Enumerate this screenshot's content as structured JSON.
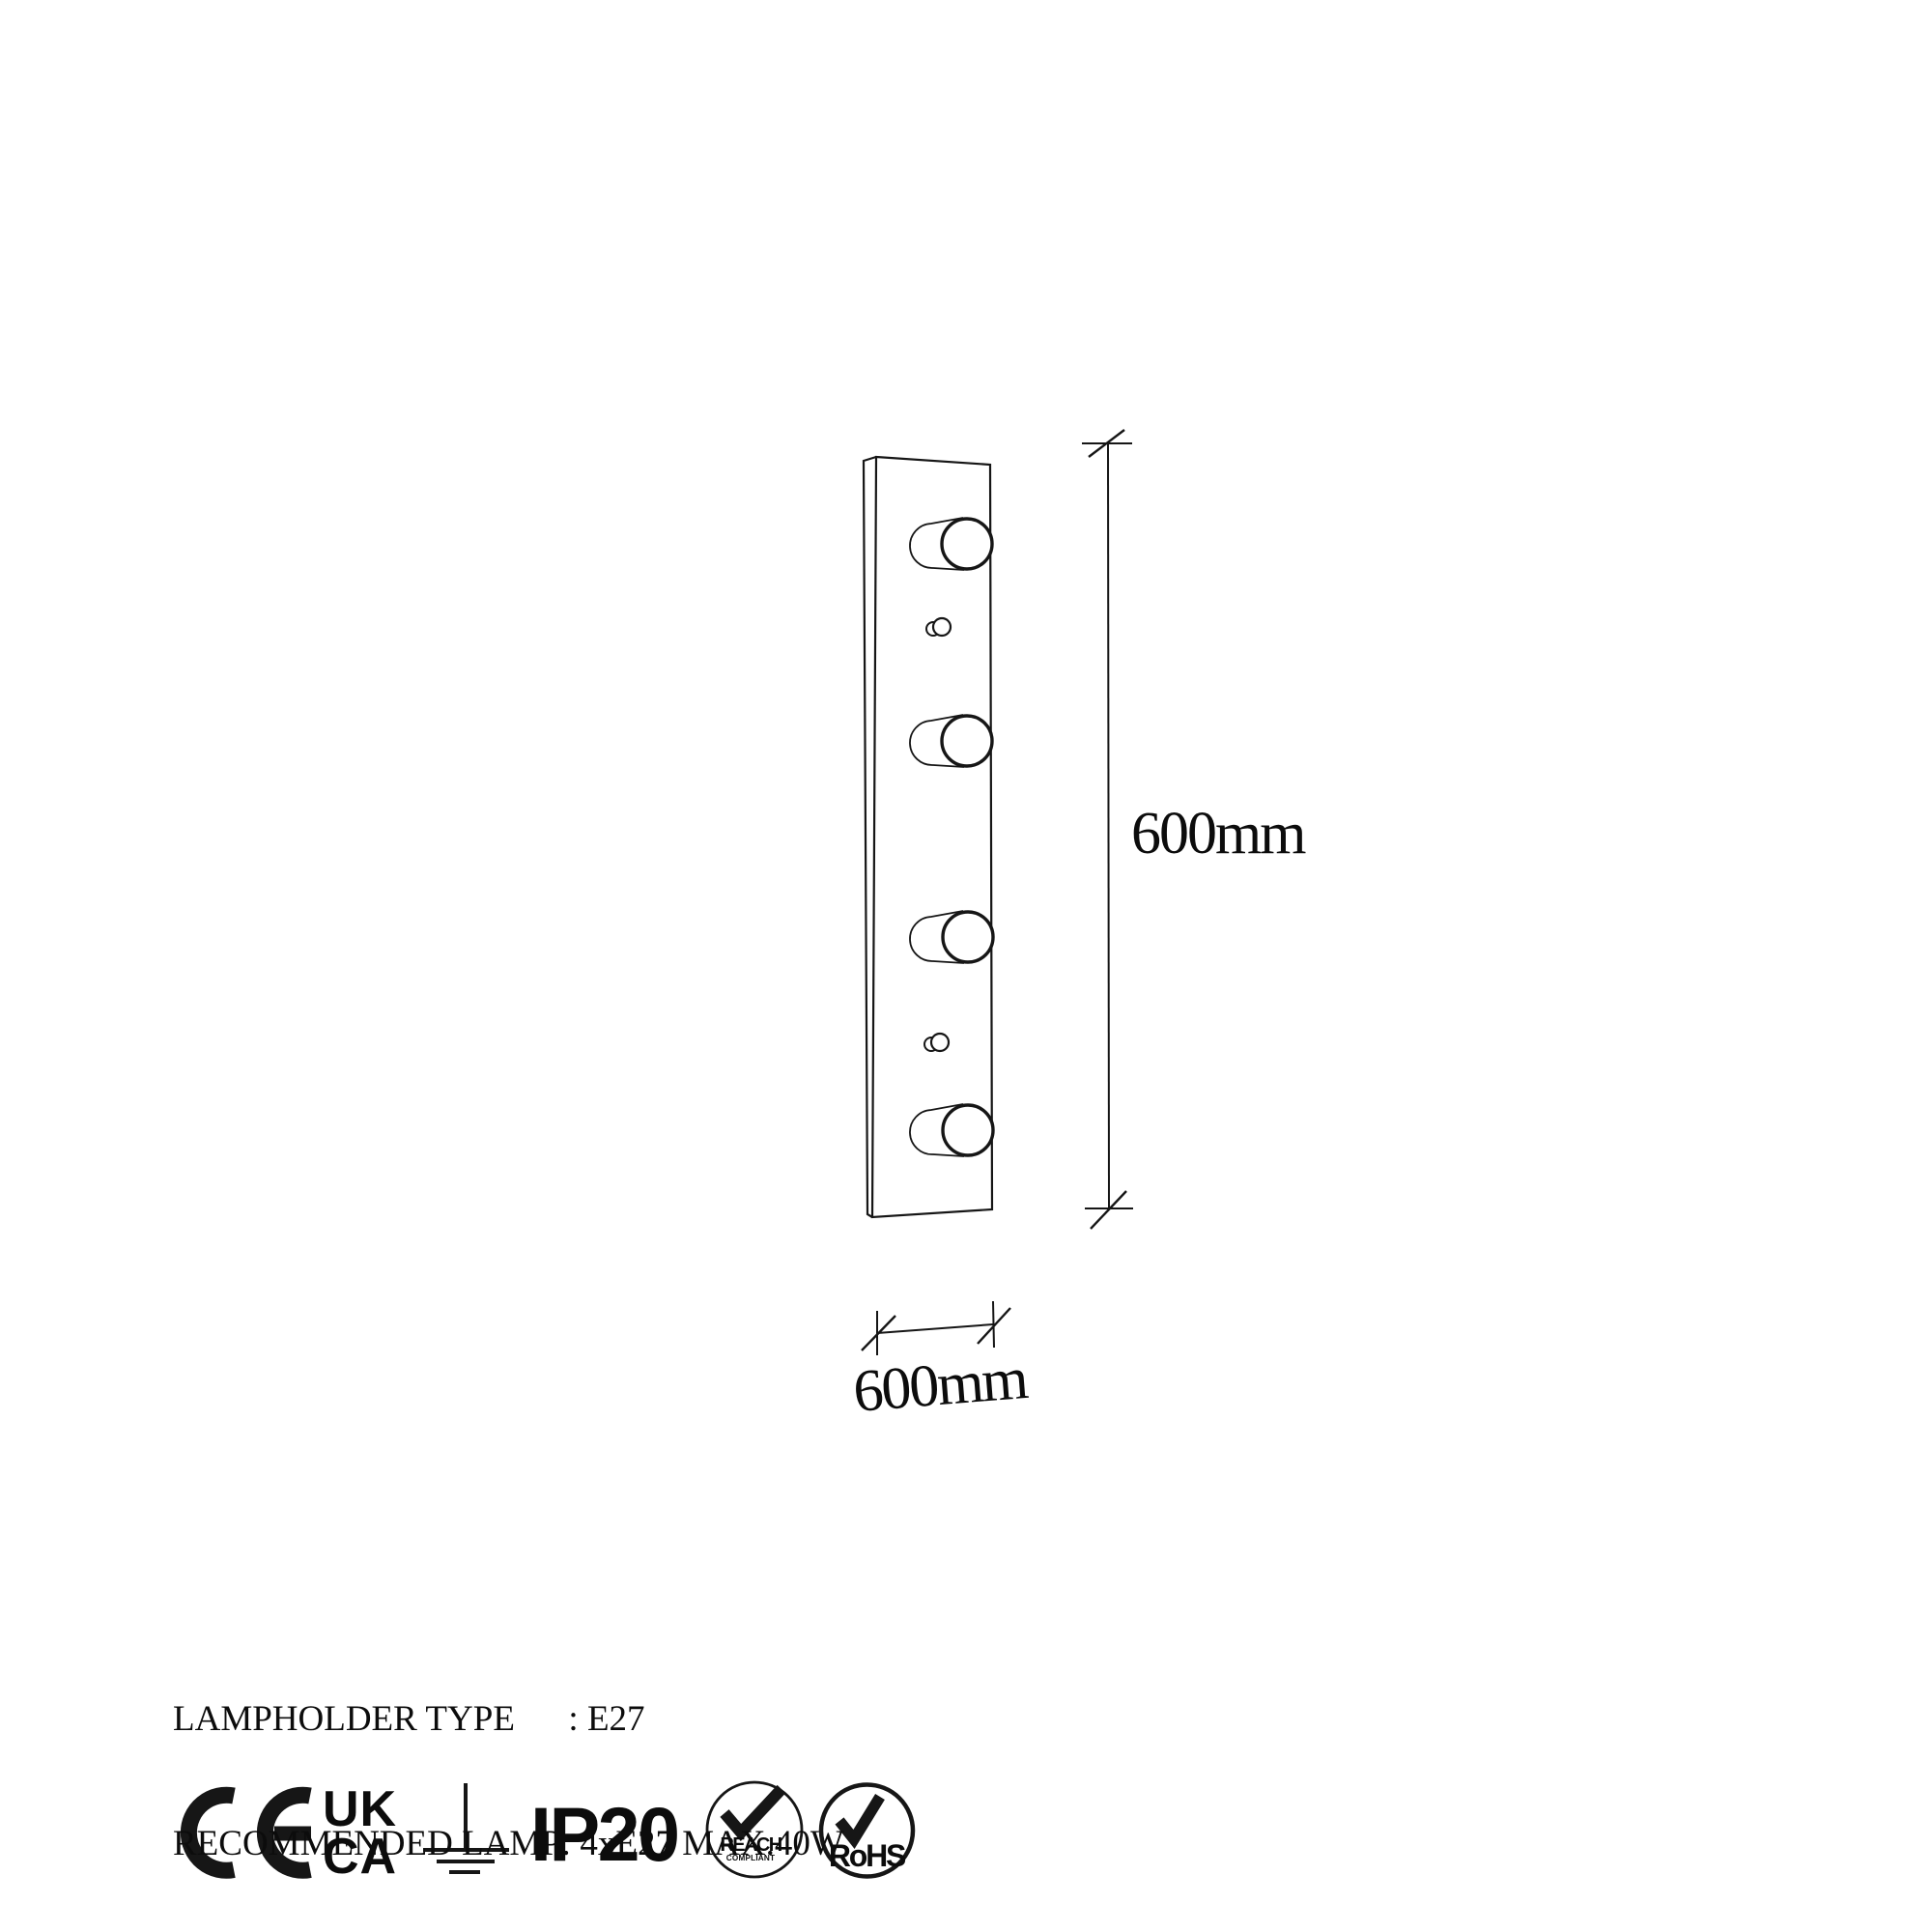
{
  "page": {
    "background": "#ffffff",
    "ink": "#161616"
  },
  "drawing": {
    "type": "wall-lamp-front-technical-drawing",
    "lampholder_count": 4
  },
  "dimensions": {
    "height_label": "600mm",
    "width_label": "600mm"
  },
  "specs": {
    "line1": "LAMPHOLDER TYPE      : E27",
    "line2": "RECOMMENDED LAMP: 4xE27 MAX.40W"
  },
  "certifications": {
    "ukca_line1": "UK",
    "ukca_line2": "CA",
    "ip_rating": "IP20",
    "reach_label": "REACH",
    "reach_sublabel": "COMPLIANT",
    "rohs_label": "RoHS",
    "icons": [
      "ce-mark",
      "ukca-mark",
      "earth-ground-symbol",
      "ip20-rating",
      "reach-compliant-badge",
      "rohs-badge"
    ]
  }
}
